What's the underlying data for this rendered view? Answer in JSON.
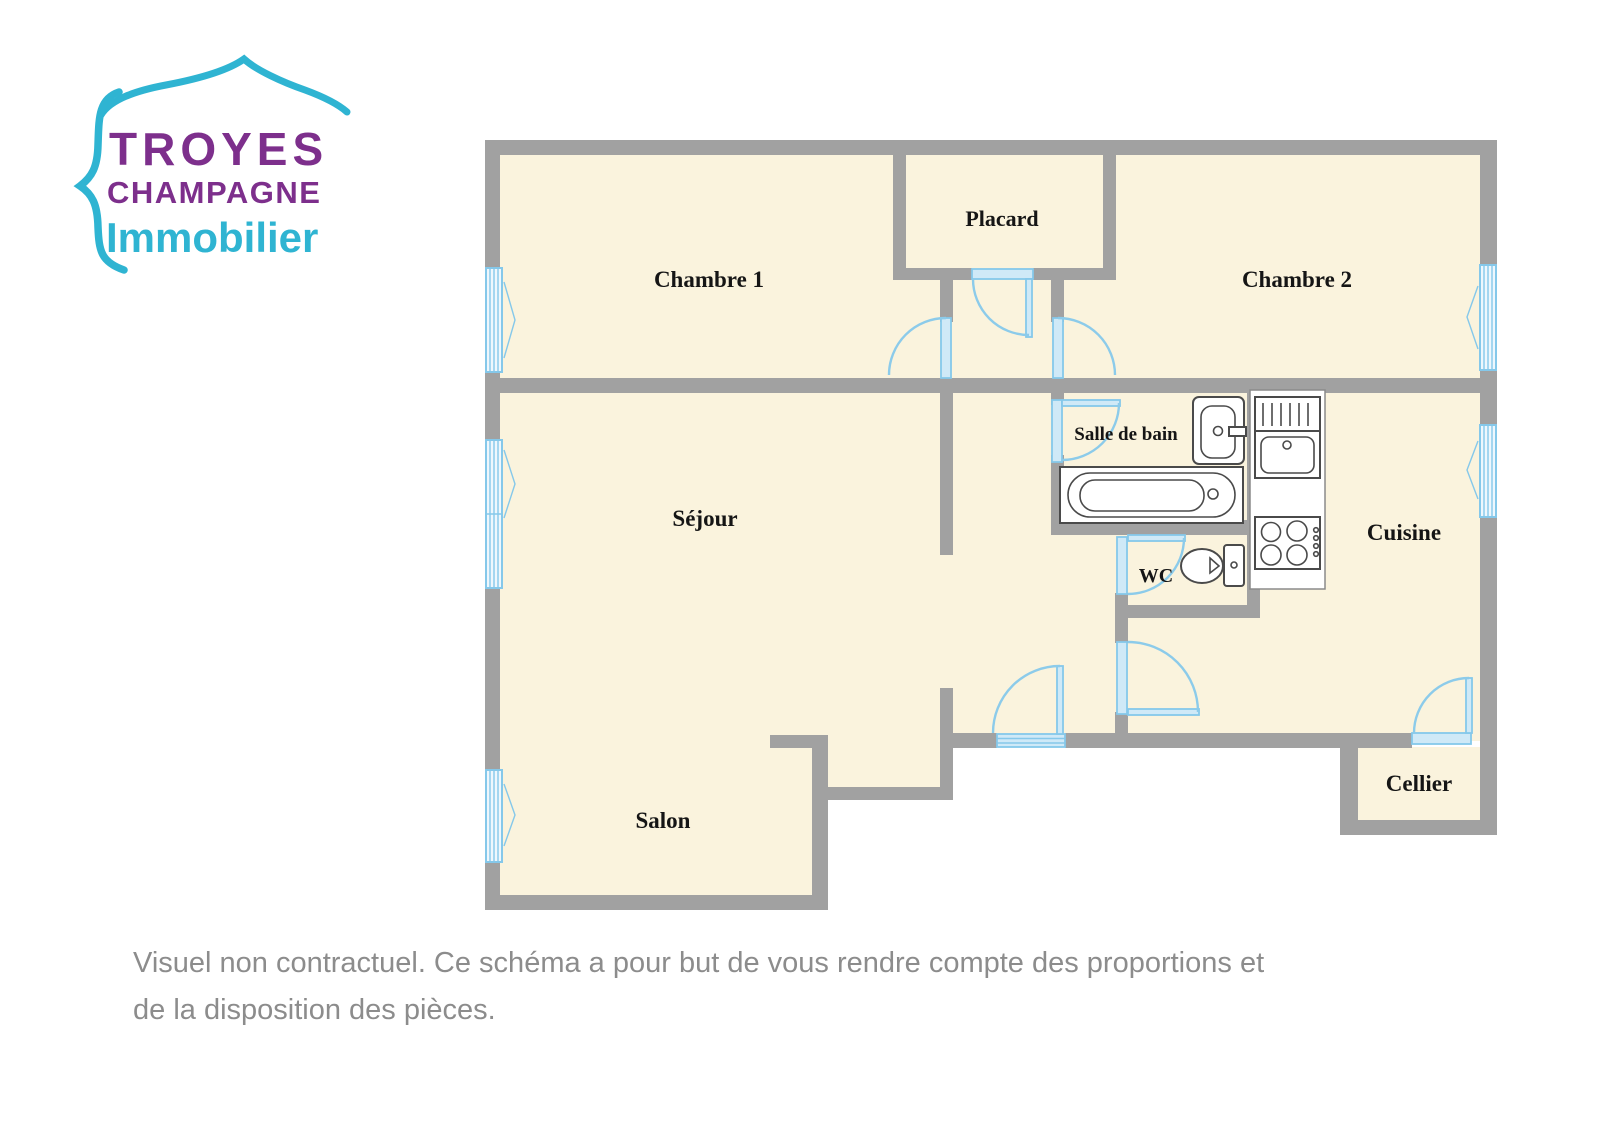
{
  "logo": {
    "line1": "TROYES",
    "line2": "CHAMPAGNE",
    "line3": "Immobilier"
  },
  "floorplan": {
    "rooms": {
      "chambre1": "Chambre 1",
      "placard": "Placard",
      "chambre2": "Chambre 2",
      "salle_de_bain": "Salle de bain",
      "sejour": "Séjour",
      "wc": "WC",
      "cuisine": "Cuisine",
      "salon": "Salon",
      "cellier": "Cellier"
    },
    "fixtures": [
      "bathtub",
      "washbasin",
      "toilet",
      "kitchen-sink",
      "dish-drainer",
      "stove"
    ],
    "symbols": [
      "door-swing",
      "window"
    ]
  },
  "disclaimer": {
    "line1": "Visuel non contractuel. Ce schéma a pour but de vous rendre compte des proportions et",
    "line2": "de la disposition des pièces."
  },
  "colors": {
    "wall_gray": "#a1a1a1",
    "floor_cream": "#faf3dd",
    "door_window_blue": "#85c8ea",
    "door_fill_blue": "#cfe9f7",
    "fixture_stroke": "#4a4a4a",
    "logo_purple": "#7d2f8c",
    "logo_teal": "#2fb4d2",
    "label_black": "#151515",
    "disclaimer_gray": "#8c8c8c",
    "background": "#ffffff"
  }
}
